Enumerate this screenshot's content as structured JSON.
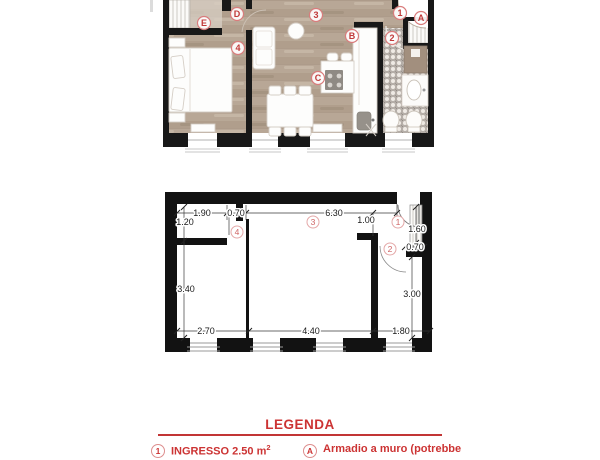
{
  "colors": {
    "accent_red": "#cc3333",
    "room_label_red": "#c23a3a",
    "wall_black": "#181818",
    "wood_floor": "#b8a796",
    "mosaic_gray": "#b9b2ac",
    "counter_brown": "#a28f7e"
  },
  "top_plan": {
    "room_labels": [
      "E",
      "D",
      "3",
      "1",
      "A",
      "B",
      "2",
      "4",
      "C"
    ]
  },
  "bottom_plan": {
    "room_labels": [
      "4",
      "3",
      "1",
      "2"
    ],
    "dimensions": [
      "1.90",
      "0.70",
      "6.30",
      "1.00",
      "1.20",
      "1.60",
      "0.70",
      "3.40",
      "3.00",
      "2.70",
      "4.40",
      "1.80"
    ]
  },
  "legend": {
    "title": "LEGENDA",
    "items": [
      {
        "marker": "1",
        "label": "INGRESSO 2.50 m",
        "sup": "2"
      },
      {
        "marker": "A",
        "label": "Armadio a muro (potrebbe"
      }
    ]
  }
}
